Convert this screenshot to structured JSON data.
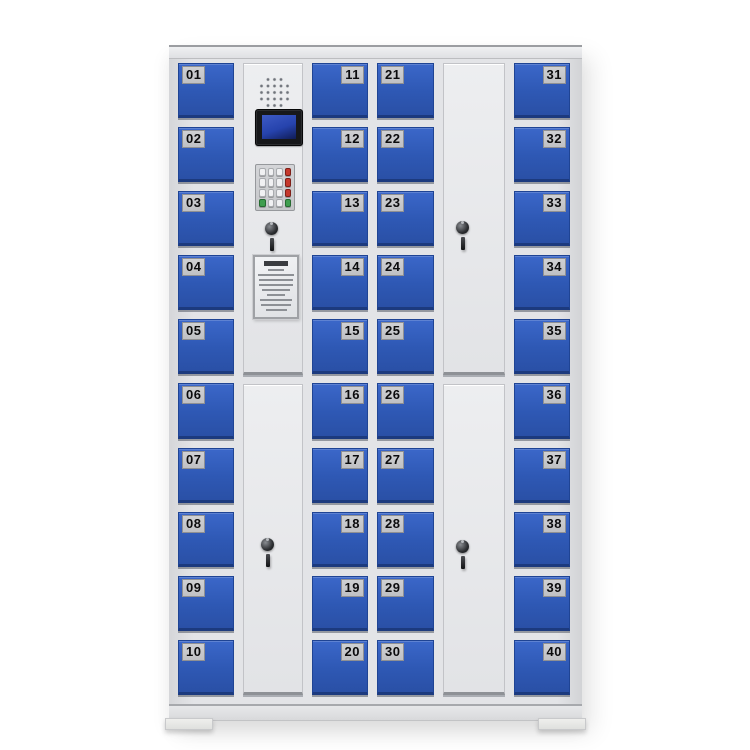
{
  "cabinet": {
    "locker_columns": [
      {
        "position": "col-1",
        "plate_side": "left",
        "numbers": [
          "01",
          "02",
          "03",
          "04",
          "05",
          "06",
          "07",
          "08",
          "09",
          "10"
        ]
      },
      {
        "position": "col-3",
        "plate_side": "right",
        "numbers": [
          "11",
          "12",
          "13",
          "14",
          "15",
          "16",
          "17",
          "18",
          "19",
          "20"
        ]
      },
      {
        "position": "col-4",
        "plate_side": "left",
        "numbers": [
          "21",
          "22",
          "23",
          "24",
          "25",
          "26",
          "27",
          "28",
          "29",
          "30"
        ]
      },
      {
        "position": "col-6",
        "plate_side": "right",
        "numbers": [
          "31",
          "32",
          "33",
          "34",
          "35",
          "36",
          "37",
          "38",
          "39",
          "40"
        ]
      }
    ],
    "control_panel": {
      "components": [
        "speaker-grille",
        "lcd-screen",
        "keypad",
        "key-lock",
        "instruction-card"
      ],
      "keypad": {
        "rows": 4,
        "cols": 4,
        "keys": [
          "grey",
          "grey",
          "grey",
          "red",
          "grey",
          "grey",
          "grey",
          "red",
          "grey",
          "grey",
          "grey",
          "red",
          "green",
          "grey",
          "grey",
          "green"
        ]
      },
      "instruction_card": {
        "title_bar_width_pct": 58,
        "line_widths_pct": [
          36,
          84,
          80,
          82,
          66,
          44,
          78,
          70,
          50
        ]
      }
    },
    "service_doors": {
      "count": 3,
      "locks_with_keys": 4
    }
  },
  "colors": {
    "background": "#ffffff",
    "frame_grey": "#e2e3e6",
    "door_blue": "#2e58b4",
    "door_blue_dark": "#1c3a7e",
    "plate_grey": "#c0c1c4",
    "plate_text": "#0b0b0d",
    "lcd_screen_blue": "#2643ad",
    "key_red": "#c5382c",
    "key_green": "#3f9e4f"
  }
}
